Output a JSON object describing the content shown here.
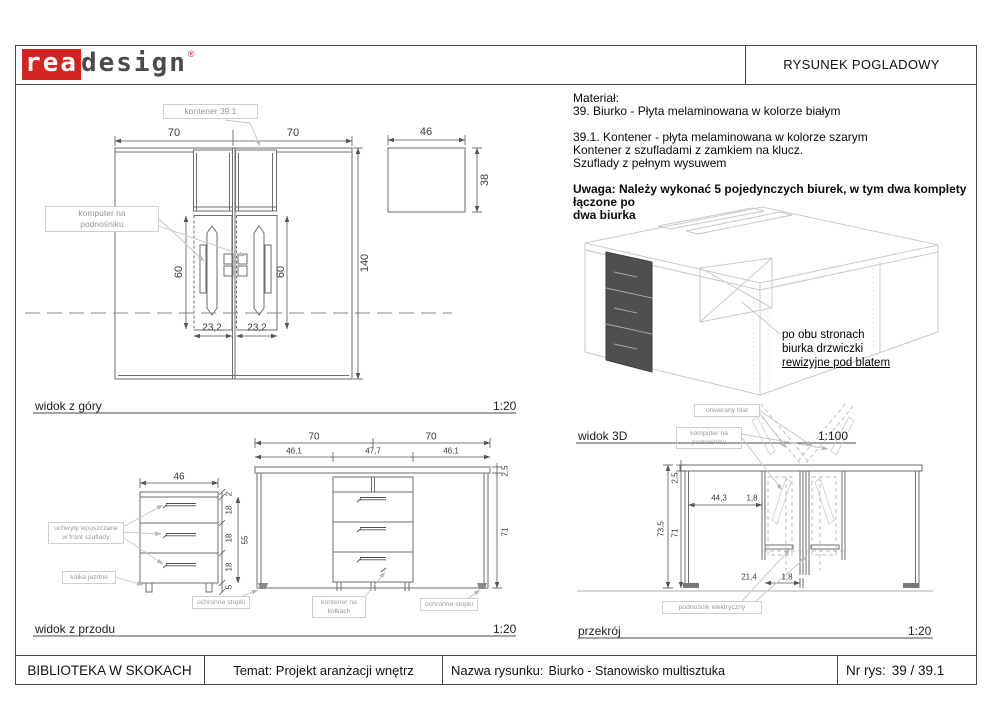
{
  "header": {
    "logo_rea": "rea",
    "logo_design": "design",
    "logo_reg": "®",
    "title": "RYSUNEK POGLADOWY",
    "accent_red": "#d42421"
  },
  "notes": {
    "material_label": "Materiał:",
    "item_39": "39. Biurko - Płyta melaminowana w kolorze białym",
    "item_391_line1": "39.1. Kontener - płyta melaminowana w kolorze szarym",
    "item_391_line2": "Kontener z szufladami z zamkiem na klucz.",
    "item_391_line3": "Szuflady z pełnym wysuwem",
    "warning_line1": "Uwaga: Należy wykonać 5 pojedynczych biurek, w tym dwa komplety łączone po",
    "warning_line2": "dwa biurka"
  },
  "views": {
    "top": {
      "label": "widok z góry",
      "scale": "1:20"
    },
    "front": {
      "label": "widok z przodu",
      "scale": "1:20"
    },
    "three_d": {
      "label": "widok 3D",
      "scale": "1:100"
    },
    "section": {
      "label": "przekrój",
      "scale": "1:20"
    }
  },
  "annotations": {
    "kontener_ref": "kontener 39.1",
    "komputer_line1": "komputer na",
    "komputer_line2": "podnośniku",
    "uchwyty_line1": "uchwyty wpuszczane",
    "uchwyty_line2": "w front szuflady",
    "kolka": "kółka jezdne",
    "stopki": "ochronne stopki",
    "kontener_kolka_line1": "kontener na",
    "kontener_kolka_line2": "kółkach",
    "rewizyjne_line1": "po obu stronach",
    "rewizyjne_line2": "biurka drzwiczki",
    "rewizyjne_line3": "rewizyjne pod blatem",
    "otwierany": "otwierany blat",
    "podnosnik": "podnośnik elektryczny"
  },
  "dims": {
    "top": {
      "w1": "70",
      "w2": "70",
      "depth": "140",
      "comp1": "60",
      "comp2": "60",
      "front1": "23,2",
      "front2": "23,2"
    },
    "kontener_top": {
      "w": "46",
      "d": "38"
    },
    "kontener_front": {
      "w": "46",
      "top": "2",
      "d1": "18",
      "d2": "18",
      "d3": "18",
      "body": "55",
      "feet": "5"
    },
    "desk_front": {
      "w1": "70",
      "w2": "70",
      "s1": "46,1",
      "mid": "47,7",
      "s2": "46,1",
      "top": "2,5",
      "h": "71"
    },
    "section": {
      "top": "2,5",
      "total": "73,5",
      "h": "71",
      "a": "44,3",
      "t1": "1,8",
      "b": "21,4",
      "t2": "1,8"
    }
  },
  "titleblock": {
    "company": "BIBLIOTEKA W SKOKACH",
    "topic": "Temat: Projekt aranżacji wnętrz",
    "name_label": "Nazwa rysunku:",
    "name": "Biurko - Stanowisko multisztuka",
    "nr_label": "Nr rys:",
    "nr": "39 / 39.1"
  }
}
